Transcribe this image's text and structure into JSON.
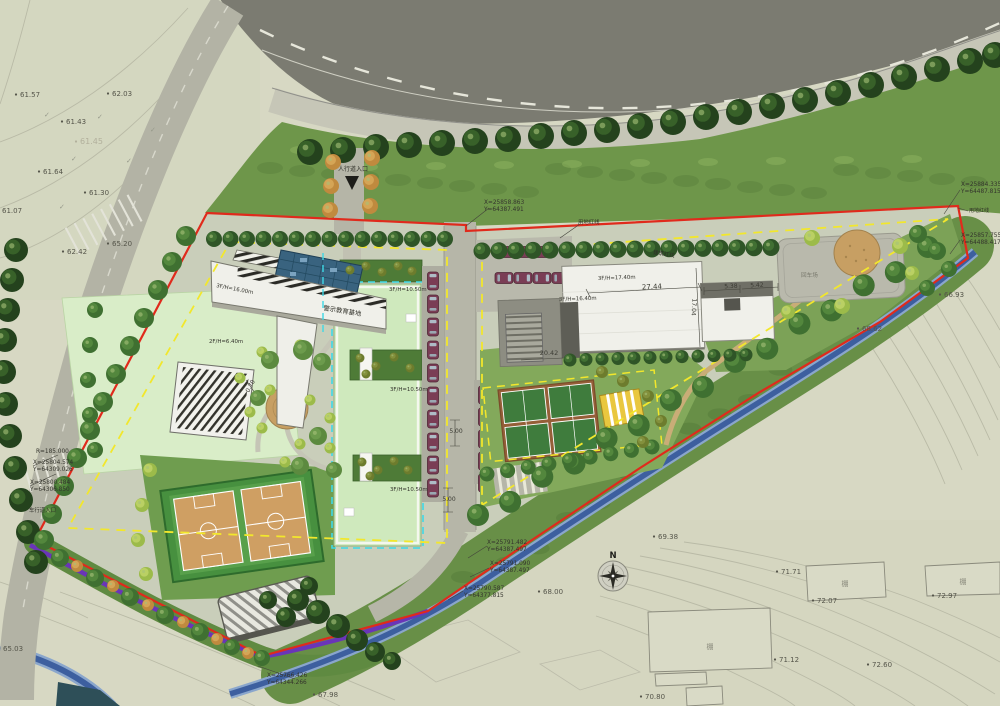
{
  "labels": {
    "education_base": "警示教育基地",
    "redline_top": "用地红线",
    "redline_right": "用地红线",
    "building_redline": "建筑红线",
    "turnaround": "回车场",
    "pedestrian_entrance": "人行道入口",
    "vehicle_entrance": "车行道入口",
    "shed": "棚",
    "north": "N"
  },
  "building_labels": [
    {
      "text": "3F/H=16.00m",
      "x": 216,
      "y": 287,
      "rot": 11
    },
    {
      "text": "2F/H=6.40m",
      "x": 209,
      "y": 343,
      "rot": 0
    },
    {
      "text": "3F/H=10.50m",
      "x": 389,
      "y": 291,
      "rot": 0
    },
    {
      "text": "3F/H=10.50m",
      "x": 390,
      "y": 391,
      "rot": 0
    },
    {
      "text": "3F/H=10.50m",
      "x": 390,
      "y": 491,
      "rot": 0
    },
    {
      "text": "3F/H=17.40m",
      "x": 598,
      "y": 280,
      "rot": -2
    },
    {
      "text": "3F/H=16.40m",
      "x": 559,
      "y": 301,
      "rot": -2
    }
  ],
  "dimensions": [
    {
      "text": "27.44",
      "x": 652,
      "y": 289,
      "rot": -3,
      "fs": 7
    },
    {
      "text": "17.04",
      "x": 692,
      "y": 307,
      "rot": 93,
      "fs": 6
    },
    {
      "text": "5.38",
      "x": 731,
      "y": 288,
      "rot": -3,
      "fs": 6
    },
    {
      "text": "5.42",
      "x": 757,
      "y": 287,
      "rot": -3,
      "fs": 6
    },
    {
      "text": "20.42",
      "x": 549,
      "y": 355,
      "rot": 0,
      "fs": 6.5
    },
    {
      "text": "5.00",
      "x": 456,
      "y": 433,
      "rot": 0,
      "fs": 6
    },
    {
      "text": "5.00",
      "x": 449,
      "y": 501,
      "rot": 0,
      "fs": 6
    },
    {
      "text": "0.70",
      "x": 252,
      "y": 387,
      "rot": -62,
      "fs": 6
    }
  ],
  "elevations": [
    {
      "text": "61.57",
      "x": 20,
      "y": 97
    },
    {
      "text": "62.03",
      "x": 112,
      "y": 96
    },
    {
      "text": "61.43",
      "x": 66,
      "y": 124
    },
    {
      "text": "61.45",
      "x": 80,
      "y": 144,
      "faint": true
    },
    {
      "text": "61.64",
      "x": 43,
      "y": 174
    },
    {
      "text": "61.30",
      "x": 89,
      "y": 195
    },
    {
      "text": "61.07",
      "x": 2,
      "y": 213
    },
    {
      "text": "65.20",
      "x": 112,
      "y": 246
    },
    {
      "text": "62.42",
      "x": 67,
      "y": 254
    },
    {
      "text": "65.03",
      "x": 3,
      "y": 651
    },
    {
      "text": "67.98",
      "x": 318,
      "y": 697
    },
    {
      "text": "68.00",
      "x": 543,
      "y": 594
    },
    {
      "text": "66.93",
      "x": 944,
      "y": 297
    },
    {
      "text": "68.62",
      "x": 862,
      "y": 331
    },
    {
      "text": "69.38",
      "x": 658,
      "y": 539
    },
    {
      "text": "70.80",
      "x": 645,
      "y": 699
    },
    {
      "text": "71.12",
      "x": 779,
      "y": 662
    },
    {
      "text": "71.71",
      "x": 781,
      "y": 574
    },
    {
      "text": "72.07",
      "x": 817,
      "y": 603
    },
    {
      "text": "72.60",
      "x": 872,
      "y": 667
    },
    {
      "text": "72.97",
      "x": 937,
      "y": 598
    }
  ],
  "coordinates": [
    {
      "x": 484,
      "y": 204,
      "lines": [
        "X=25858.863",
        "Y=64387.491"
      ]
    },
    {
      "x": 961,
      "y": 186,
      "lines": [
        "X=25884.335",
        "Y=64487.815"
      ]
    },
    {
      "x": 961,
      "y": 237,
      "lines": [
        "X=25857.755",
        "Y=64488.417"
      ]
    },
    {
      "x": 36,
      "y": 453,
      "lines": [
        "R=185.000"
      ]
    },
    {
      "x": 33,
      "y": 464,
      "lines": [
        "X=25804.574",
        "Y=64309.026"
      ]
    },
    {
      "x": 30,
      "y": 484,
      "lines": [
        "X=25800.484",
        "Y=64306.850"
      ]
    },
    {
      "x": 487,
      "y": 544,
      "lines": [
        "X=25791.482",
        "Y=64387.497"
      ]
    },
    {
      "x": 490,
      "y": 565,
      "lines": [
        "X=25791.090",
        "Y=64387.497"
      ]
    },
    {
      "x": 464,
      "y": 590,
      "lines": [
        "X=25790.587",
        "Y=64377.815"
      ]
    },
    {
      "x": 267,
      "y": 677,
      "lines": [
        "X=25766.426",
        "Y=64344.266"
      ]
    }
  ],
  "survey_marks": [
    {
      "glyph": "✓",
      "x": 44,
      "y": 117
    },
    {
      "glyph": "✓",
      "x": 97,
      "y": 119
    },
    {
      "glyph": "✓",
      "x": 71,
      "y": 161
    },
    {
      "glyph": "✓",
      "x": 126,
      "y": 163
    },
    {
      "glyph": "✓",
      "x": 59,
      "y": 209
    },
    {
      "glyph": "✓",
      "x": 150,
      "y": 132
    }
  ],
  "colors": {
    "boundary_red": "#e02a1c",
    "setback_yellow": "#f2e72c",
    "reference_cyan": "#3ed8e6",
    "stream_blue": "#3d5f9f",
    "pipeline_purple": "#6a35b8",
    "road_gray": "#7b7b71",
    "grass_green": "#6e964a",
    "lawn_pale": "#d9edc8",
    "roof_pale_green": "#cfe9bd"
  }
}
